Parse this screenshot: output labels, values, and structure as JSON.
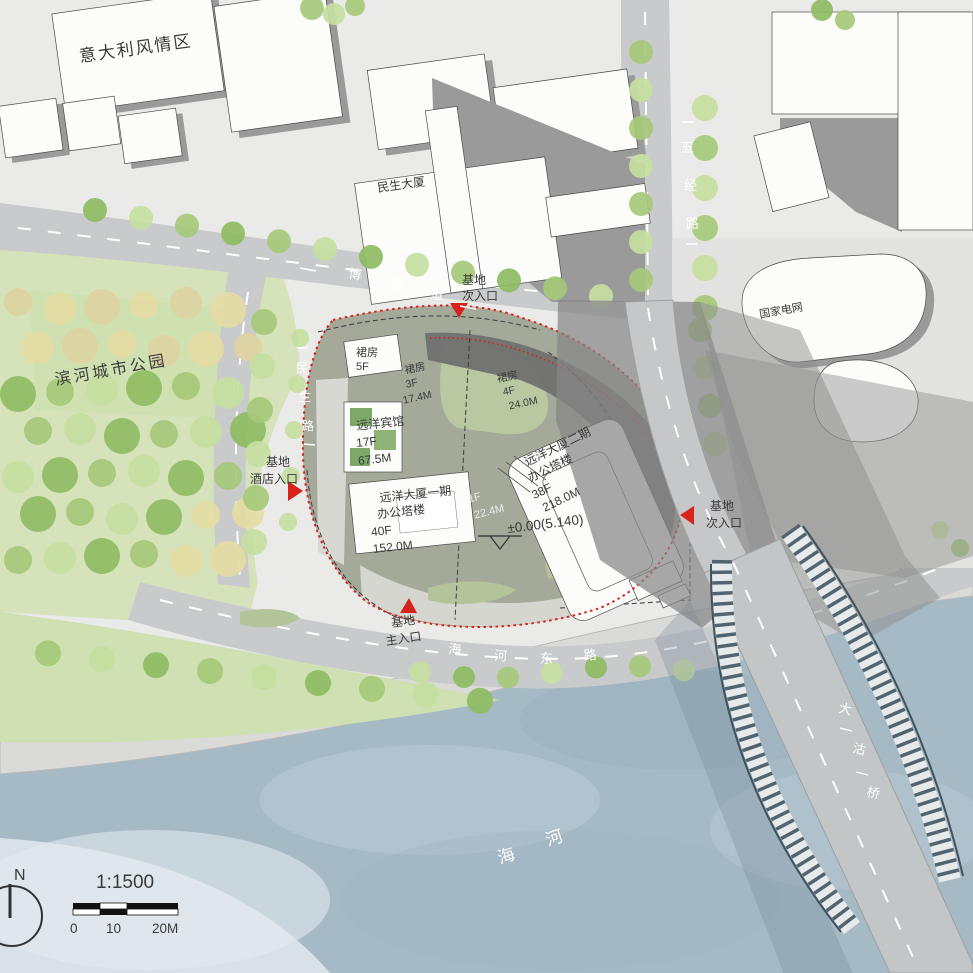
{
  "areas": {
    "italian_district": "意大利风情区",
    "minsheng_building": "民生大厦",
    "state_grid": "国家电网",
    "riverside_park": "滨河城市公园"
  },
  "roads": {
    "wujing": {
      "name": "五经路",
      "chars": [
        "五",
        "经",
        "路"
      ]
    },
    "boai": {
      "name": "博爱道",
      "chars": [
        "博",
        "爱",
        "道"
      ]
    },
    "minsheng": {
      "name": "民生路",
      "chars": [
        "民",
        "生",
        "路"
      ]
    },
    "haihe_east": {
      "name": "海河东路",
      "chars": [
        "海",
        "河",
        "东",
        "路"
      ]
    },
    "dagu_bridge": {
      "name": "大沽桥",
      "chars": [
        "大",
        "沽",
        "桥"
      ]
    },
    "haihe_river": {
      "name": "海河",
      "chars": [
        "海",
        "河"
      ]
    }
  },
  "site": {
    "podium_5f": {
      "name": "裙房",
      "floors": "5F"
    },
    "podium_3f": {
      "name": "裙房",
      "floors": "3F",
      "height": "17.4M"
    },
    "podium_4f": {
      "name": "裙房",
      "floors": "4F",
      "height": "24.0M"
    },
    "hotel": {
      "name": "远洋宾馆",
      "floors": "17F",
      "height": "67.5M"
    },
    "tower_phase1": {
      "line1": "远洋大厦一期",
      "line2": "办公塔楼",
      "floors": "40F",
      "height": "152.0M"
    },
    "tower_phase2": {
      "line1": "远洋大厦二期",
      "line2": "办公塔楼",
      "floors": "38F",
      "height": "218.0M"
    },
    "podium_1f": {
      "floors": "1F",
      "height": "22.4M"
    },
    "level_datum": "±0.00(5.140)"
  },
  "entrances": {
    "north_secondary": {
      "line1": "基地",
      "line2": "次入口"
    },
    "hotel_entry": {
      "line1": "基地",
      "line2": "酒店入口"
    },
    "east_secondary": {
      "line1": "基地",
      "line2": "次入口"
    },
    "main_entry": {
      "line1": "基地",
      "line2": "主入口"
    }
  },
  "legend": {
    "scale_ratio": "1:1500",
    "tick0": "0",
    "tick10": "10",
    "tick20": "20M",
    "north": "N"
  },
  "colors": {
    "accent_red": "#d8231d",
    "river_blue": "#a6bac6",
    "park_green": "#d6e3ba",
    "tree_green": "#a6c97a",
    "site_olive": "#a4a99a",
    "road_gray": "#c9cacb",
    "building_white": "#fcfcfb",
    "shadow_gray": "#8d8d8d"
  }
}
